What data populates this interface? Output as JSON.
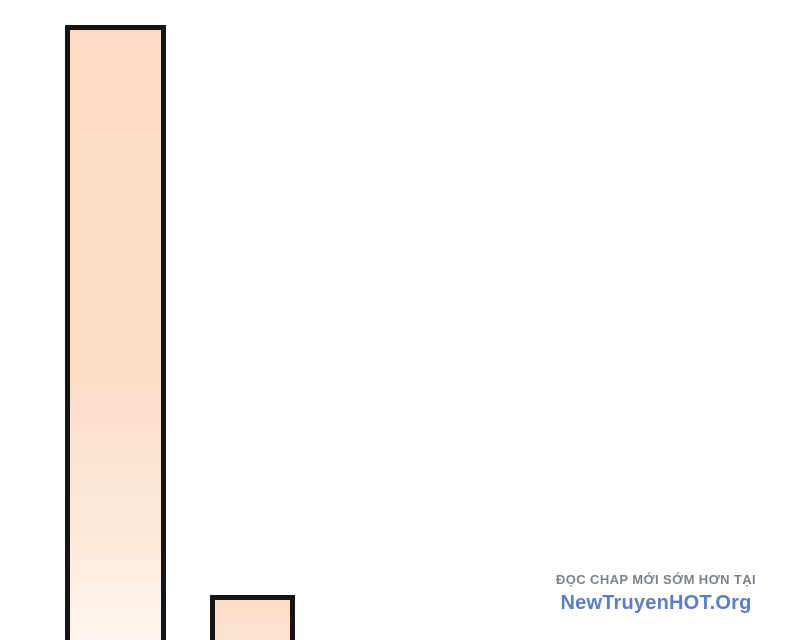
{
  "page": {
    "background": "#ffffff"
  },
  "panels": {
    "tall": {
      "border_color": "#151515",
      "stops": [
        {
          "c": "#fbdbc3",
          "p": "0%"
        },
        {
          "c": "#fbdcc6",
          "p": "55%"
        },
        {
          "c": "#fde8d7",
          "p": "82%"
        },
        {
          "c": "#fdf5ee",
          "p": "100%"
        }
      ]
    },
    "small": {
      "border_color": "#151515",
      "stops": [
        {
          "c": "#fbdcc5",
          "p": "0%"
        },
        {
          "c": "#fce3d0",
          "p": "100%"
        }
      ]
    }
  },
  "watermark": {
    "tagline": "ĐỌC CHAP MỚI SỚM HƠN TẠI",
    "tagline_color": "#7b818c",
    "site_name": "NewTruyenHOT.Org",
    "site_color": "#5b7ec5"
  }
}
